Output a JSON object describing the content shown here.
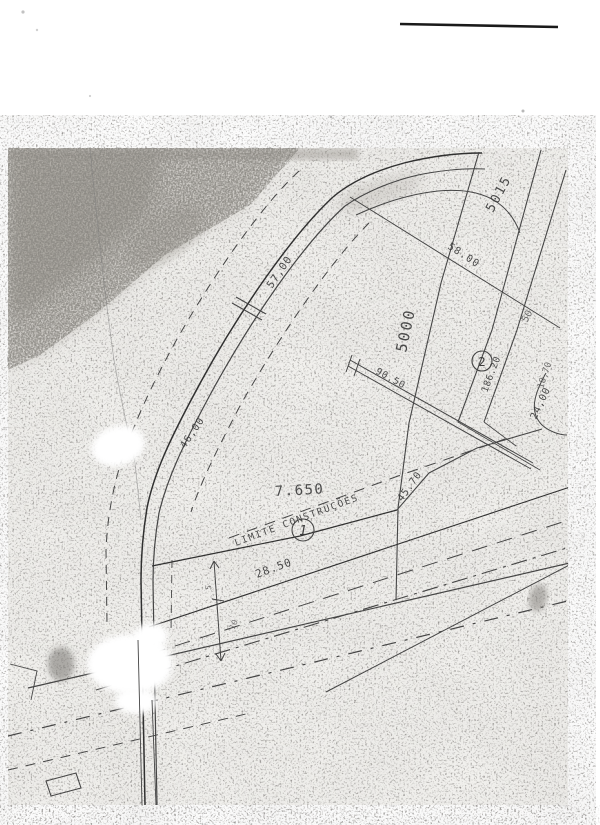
{
  "document": {
    "type_note": "scanned cadastral plot plan",
    "colors": {
      "paper": "#f3f2ef",
      "ink": "#3c3c3c",
      "artifact": "#1a1a1a"
    }
  },
  "labels": {
    "area_value": "7.650",
    "construction_limit": "LIMITE CONSTRUÇÕES",
    "lot_1": "1",
    "lot_2": "2",
    "parcel_5000": "5000",
    "parcel_5015": "5015",
    "parcel_50_partial": "50",
    "dim_57": "57,00",
    "dim_46": "46,00",
    "dim_58": "58.00",
    "dim_90": "90.50",
    "dim_186": "186.20",
    "dim_24": "24,00",
    "dim_18": "18,70",
    "dim_45": "45.70",
    "dim_28": "28.50",
    "tick_5": "5",
    "tick_10": "10"
  }
}
